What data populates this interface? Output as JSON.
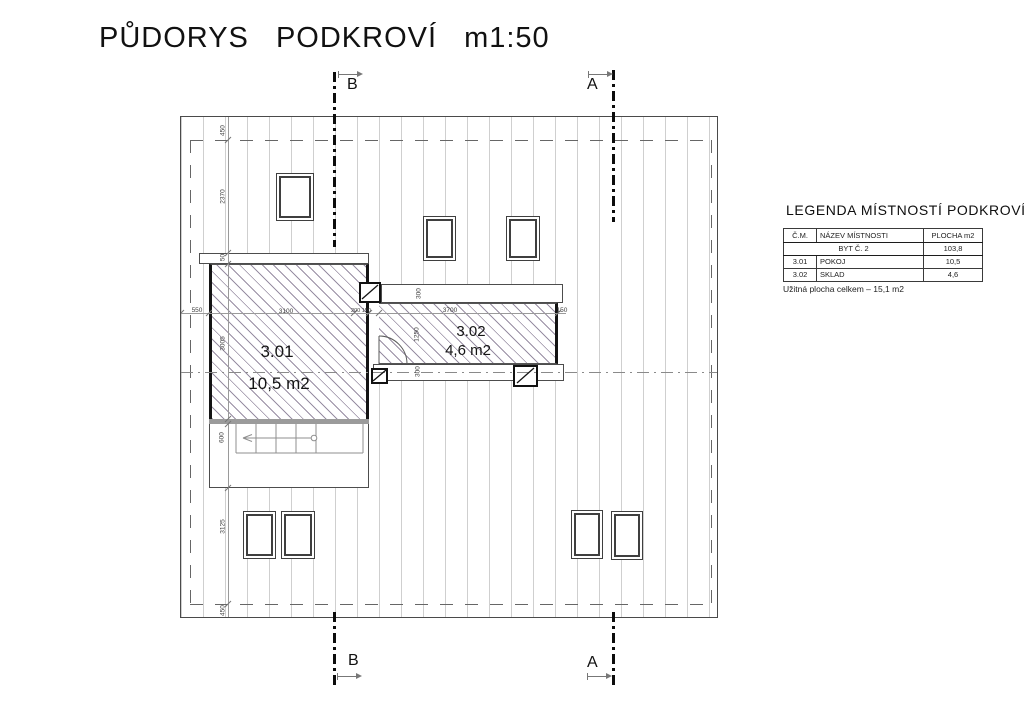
{
  "title": "PŮDORYS PODKROVÍ m1:50",
  "sections": {
    "b": "B",
    "a": "A"
  },
  "rooms": {
    "r301": {
      "number": "3.01",
      "area": "10,5 m2"
    },
    "r302": {
      "number": "3.02",
      "area": "4,6 m2"
    }
  },
  "dims": {
    "top_450": "450",
    "d2370": "2370",
    "d50": "50",
    "d550": "550",
    "d3005": "3005",
    "d600": "600",
    "d3125": "3125",
    "bottom_450": "450",
    "d3100": "3100",
    "d200_150": "200 150",
    "d3700": "3700",
    "d150": "150",
    "wall300_top": "300",
    "wall300_bottom": "300",
    "d1250": "1250"
  },
  "legend": {
    "title": "LEGENDA MÍSTNOSTÍ PODKROVÍ",
    "headers": [
      "Č.M.",
      "NÁZEV MÍSTNOSTI",
      "PLOCHA m2"
    ],
    "rows": [
      {
        "cm": "",
        "name": "BYT Č. 2",
        "area": "103,8"
      },
      {
        "cm": "3.01",
        "name": "POKOJ",
        "area": "10,5"
      },
      {
        "cm": "3.02",
        "name": "SKLAD",
        "area": "4,6"
      }
    ],
    "footer": "Užitná plocha celkem – 15,1 m2"
  },
  "colors": {
    "hatch": "#988ea3",
    "line": "#4a4a4a",
    "rafter": "#cfcfcf"
  }
}
